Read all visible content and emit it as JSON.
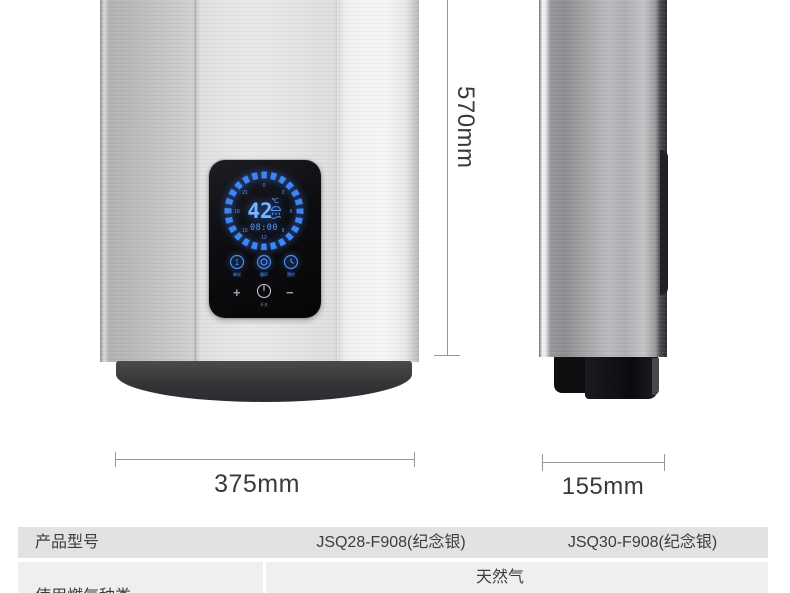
{
  "product_display": {
    "temperature_value": "42",
    "temperature_unit": "℃",
    "time": "08:00",
    "dial_numbers": [
      "0",
      "3",
      "6",
      "9",
      "12",
      "15",
      "18",
      "21"
    ],
    "touch_buttons": [
      {
        "label": "单次"
      },
      {
        "label": "循环"
      },
      {
        "label": "预约"
      }
    ],
    "plus_label": "+",
    "minus_label": "−",
    "power_label": "开关",
    "led_color": "#4d9bff"
  },
  "dimensions": {
    "height_label": "570mm",
    "width_label": "375mm",
    "depth_label": "155mm"
  },
  "spec_table": {
    "row1": {
      "label": "产品型号",
      "value_left": "JSQ28-F908(纪念银)",
      "value_right": "JSQ30-F908(纪念银)"
    },
    "row2": {
      "label": "使用燃气种类",
      "value": "天然气"
    }
  },
  "colors": {
    "row1_bg": "#e2e2e2",
    "row2_bg": "#efefef",
    "led_blue": "#4d9bff",
    "dim_line": "#979797"
  }
}
